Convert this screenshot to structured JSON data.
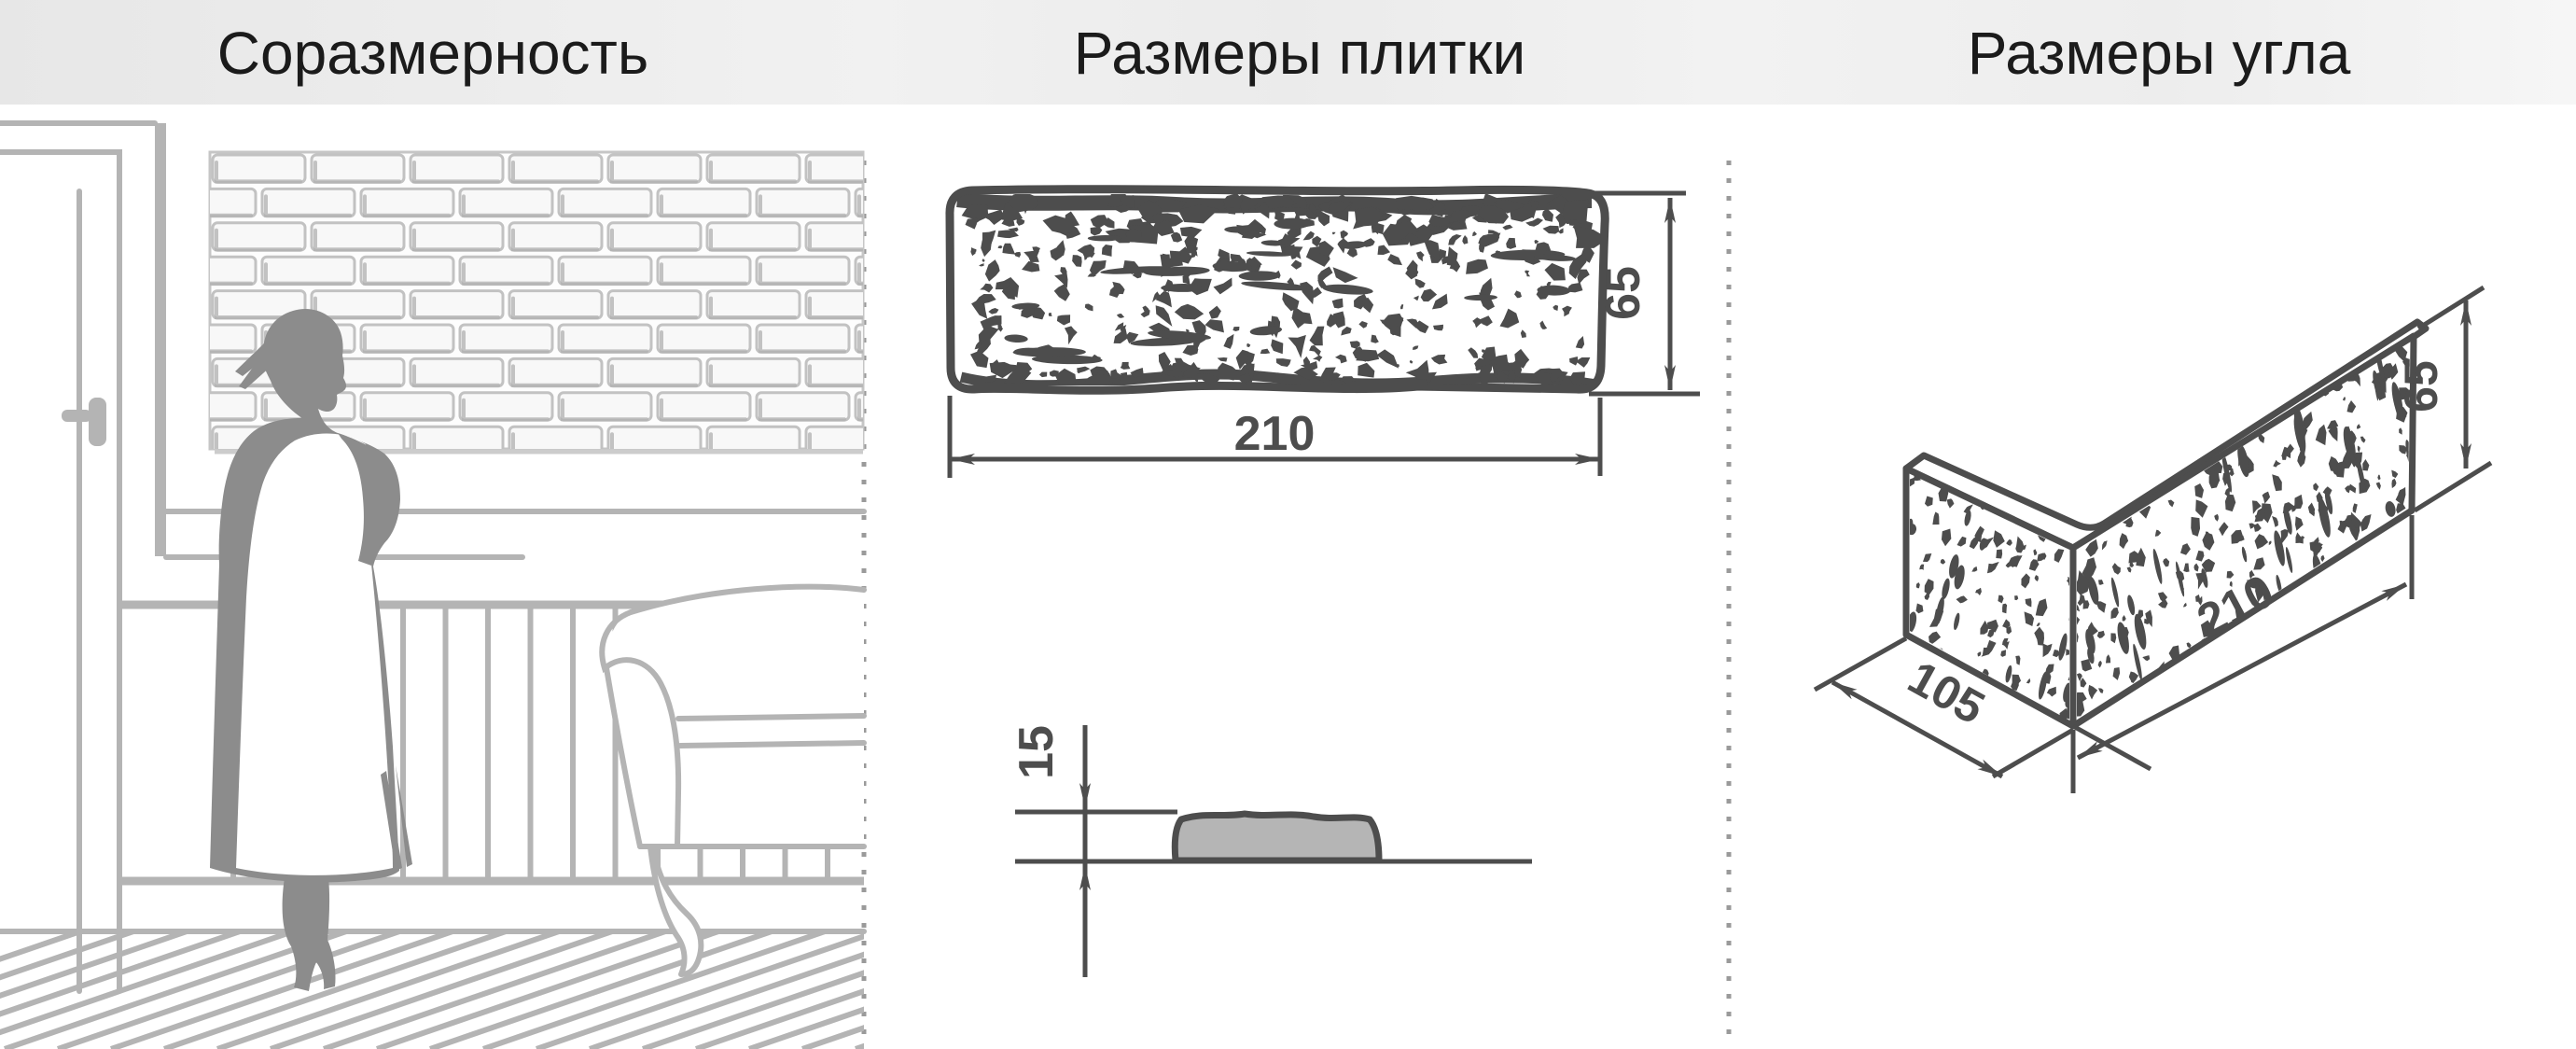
{
  "header": {
    "background": "#ededed",
    "text_color": "#1b1b1b",
    "sections": [
      {
        "title": "Соразмерность"
      },
      {
        "title": "Размеры плитки"
      },
      {
        "title": "Размеры угла"
      }
    ]
  },
  "tile_front_view": {
    "width_mm": "210",
    "height_mm": "65"
  },
  "tile_side_view": {
    "thickness_mm": "15"
  },
  "corner_view": {
    "depth_mm": "105",
    "length_mm": "210",
    "height_mm": "65"
  },
  "colors": {
    "dimension_lines": "#4d4d4d",
    "scene_line_art": "#b4b4b4",
    "silhouette": "#8c8c8c",
    "separator_dots": "#9a9a9a",
    "tile_side_fill": "#b5b5b5",
    "header_background": "#ededed"
  }
}
